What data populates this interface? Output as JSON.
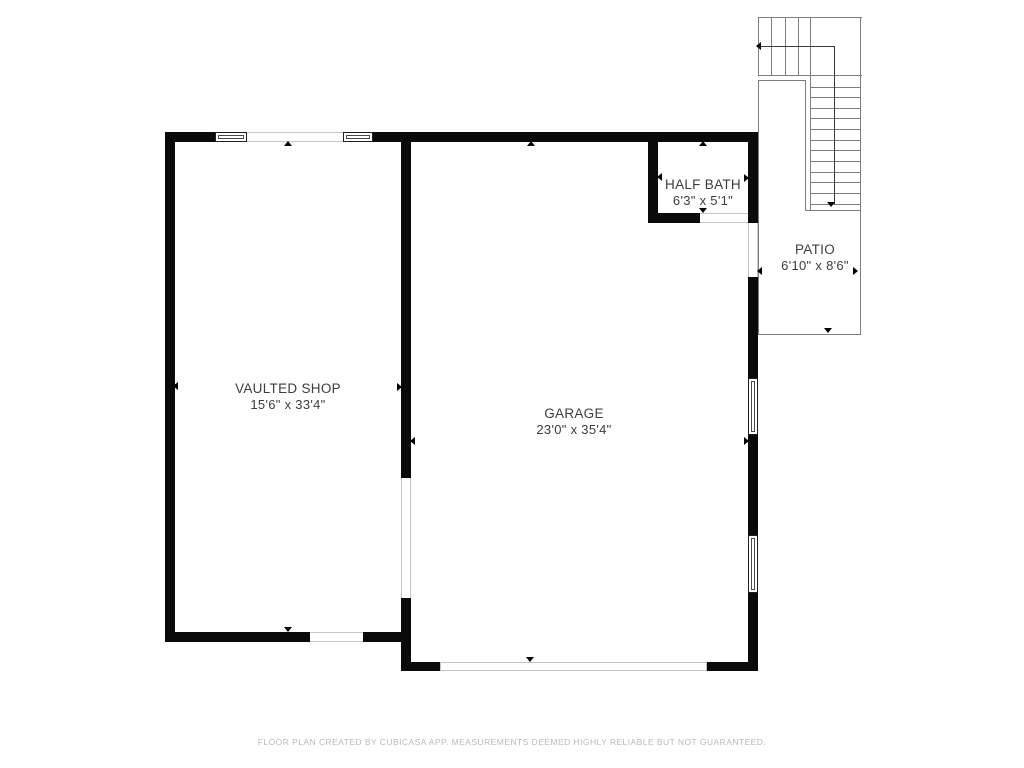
{
  "title": "Floor plan",
  "footer": {
    "text": "FLOOR PLAN CREATED BY CUBICASA APP. MEASUREMENTS DEEMED HIGHLY RELIABLE BUT NOT GUARANTEED."
  },
  "colors": {
    "wall": "#0a0a0a",
    "line": "#7d7d7d",
    "walk": "#3c3c3c",
    "label": "#3d3d3d",
    "footer_text": "#b9b9b9",
    "opening_line": "#c6c6c6"
  },
  "rooms": [
    {
      "id": "vaulted-shop",
      "name": "VAULTED SHOP",
      "dims": "15'6\" x 33'4\"",
      "cx": 288,
      "top": 381
    },
    {
      "id": "garage",
      "name": "GARAGE",
      "dims": "23'0\" x 35'4\"",
      "cx": 574,
      "top": 406
    },
    {
      "id": "half-bath",
      "name": "HALF BATH",
      "dims": "6'3\" x 5'1\"",
      "cx": 703,
      "top": 177
    },
    {
      "id": "patio",
      "name": "PATIO",
      "dims": "6'10\" x 8'6\"",
      "cx": 815,
      "top": 242
    }
  ],
  "floorplan": {
    "walls": [
      [
        165,
        132,
        50,
        10
      ],
      [
        373,
        132,
        385,
        10
      ],
      [
        165,
        132,
        10,
        510
      ],
      [
        401,
        132,
        10,
        346
      ],
      [
        401,
        598,
        10,
        73
      ],
      [
        165,
        632,
        145,
        10
      ],
      [
        363,
        632,
        48,
        10
      ],
      [
        411,
        662,
        29,
        9
      ],
      [
        707,
        662,
        51,
        9
      ],
      [
        748,
        132,
        10,
        91
      ],
      [
        748,
        277,
        10,
        101
      ],
      [
        748,
        435,
        10,
        100
      ],
      [
        748,
        593,
        10,
        78
      ],
      [
        648,
        142,
        10,
        81
      ],
      [
        648,
        213,
        52,
        10
      ]
    ],
    "windows": [
      [
        215,
        132,
        32,
        10
      ],
      [
        343,
        132,
        30,
        10
      ],
      [
        748,
        378,
        10,
        57
      ],
      [
        748,
        535,
        10,
        58
      ]
    ],
    "openings": [
      [
        247,
        132,
        96,
        10,
        "h"
      ],
      [
        310,
        632,
        53,
        10,
        "h"
      ],
      [
        700,
        213,
        48,
        10,
        "h"
      ],
      [
        748,
        223,
        10,
        54,
        "v"
      ],
      [
        401,
        478,
        10,
        120,
        "v"
      ],
      [
        440,
        662,
        267,
        9,
        "box"
      ]
    ],
    "lines": [
      [
        758,
        17,
        104,
        1,
        "line"
      ],
      [
        758,
        17,
        1,
        59,
        "line"
      ],
      [
        758,
        75,
        104,
        1,
        "line"
      ],
      [
        771,
        17,
        1,
        58,
        "line"
      ],
      [
        785,
        17,
        1,
        58,
        "line"
      ],
      [
        798,
        17,
        1,
        58,
        "line"
      ],
      [
        810,
        17,
        1,
        194,
        "line"
      ],
      [
        860,
        17,
        1,
        318,
        "line"
      ],
      [
        811,
        87,
        49,
        1,
        "line"
      ],
      [
        811,
        97,
        49,
        1,
        "line"
      ],
      [
        811,
        108,
        49,
        1,
        "line"
      ],
      [
        811,
        118,
        49,
        1,
        "line"
      ],
      [
        811,
        129,
        49,
        1,
        "line"
      ],
      [
        811,
        140,
        49,
        1,
        "line"
      ],
      [
        811,
        150,
        49,
        1,
        "line"
      ],
      [
        811,
        161,
        49,
        1,
        "line"
      ],
      [
        811,
        172,
        49,
        1,
        "line"
      ],
      [
        811,
        182,
        49,
        1,
        "line"
      ],
      [
        811,
        193,
        49,
        1,
        "line"
      ],
      [
        811,
        204,
        49,
        1,
        "line"
      ],
      [
        805,
        210,
        56,
        1,
        "line"
      ],
      [
        758,
        80,
        48,
        1,
        "line"
      ],
      [
        805,
        80,
        1,
        131,
        "line"
      ],
      [
        758,
        80,
        1,
        255,
        "line"
      ],
      [
        758,
        334,
        103,
        1,
        "line"
      ],
      [
        759,
        46,
        76,
        1,
        "walk"
      ],
      [
        834,
        46,
        1,
        158,
        "walk"
      ]
    ],
    "markers": [
      [
        288,
        141,
        "up"
      ],
      [
        288,
        632,
        "down"
      ],
      [
        173,
        386,
        "left"
      ],
      [
        402,
        387,
        "right"
      ],
      [
        531,
        141,
        "up"
      ],
      [
        530,
        662,
        "down"
      ],
      [
        410,
        441,
        "left"
      ],
      [
        749,
        441,
        "right"
      ],
      [
        703,
        141,
        "up"
      ],
      [
        703,
        213,
        "down"
      ],
      [
        657,
        177,
        "left"
      ],
      [
        749,
        178,
        "right"
      ],
      [
        828,
        333,
        "down"
      ],
      [
        757,
        271,
        "left"
      ],
      [
        858,
        271,
        "right"
      ],
      [
        831,
        207,
        "down"
      ],
      [
        756,
        46,
        "left"
      ]
    ]
  }
}
